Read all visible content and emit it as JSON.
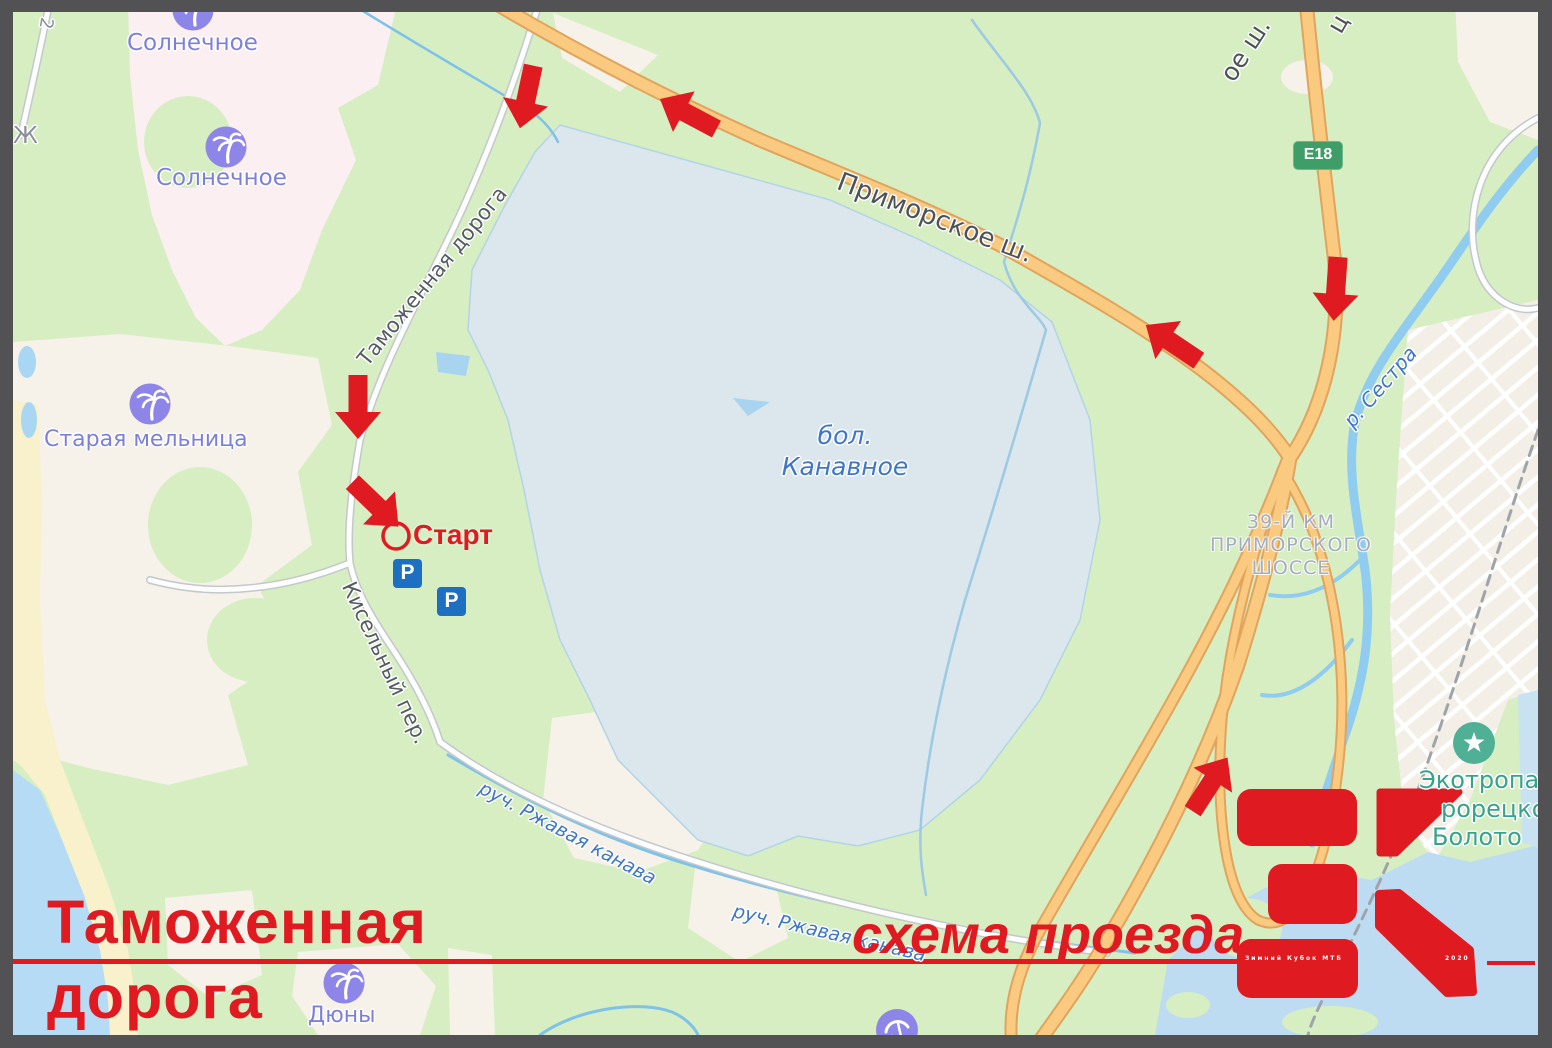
{
  "colors": {
    "accent_red": "#df1a20",
    "map_green": "#d6eec2",
    "swamp_blue": "#dbe7ed",
    "water_blue": "#b5dcf4",
    "road_orange": "#f9ca80",
    "parking_blue": "#1d6fc2",
    "shield_green": "#3f9e68",
    "poi_purple": "#8d85e8",
    "eco_teal": "#38a38b"
  },
  "overlay": {
    "title_line1": "Таможенная",
    "title_line2": "дорога",
    "caption": "схема проезда"
  },
  "logo": {
    "subtitle": "Зимний Кубок МТБ",
    "year": "2020"
  },
  "map": {
    "settlements": {
      "solnechnoe_1": "Солнечное",
      "solnechnoe_2": "Солнечное",
      "staraya_melnitsa": "Старая мельница",
      "dyuny": "Дюны"
    },
    "roads": {
      "tamozhennaya_doroga": "Таможенная дорога",
      "kiselnyy_per": "Кисельный пер.",
      "primorskoe_sh": "Приморское ш.",
      "primorskoe_sh_partial": "ое ш.",
      "top_right_partial": "ц",
      "left_partial_zh": "Ж",
      "left_partial_2": "2",
      "e18_shield": "E18",
      "km39_line1": "39-Й КМ",
      "km39_line2": "ПРИМОРСКОГО",
      "km39_line3": "ШОССЕ"
    },
    "water": {
      "bol_kanavnoe_line1": "бол.",
      "bol_kanavnoe_line2": "Канавное",
      "r_sestra": "р. Сестра",
      "ruch_rzhavaya_1": "руч. Ржавая канава",
      "ruch_rzhavaya_2": "руч. Ржавая канава"
    },
    "poi": {
      "ekotropa_line1": "Экотропа",
      "ekotropa_line2": "рорецко",
      "ekotropa_line3": "Болото"
    },
    "route": {
      "start_label": "Старт",
      "parking_letter": "P"
    }
  }
}
